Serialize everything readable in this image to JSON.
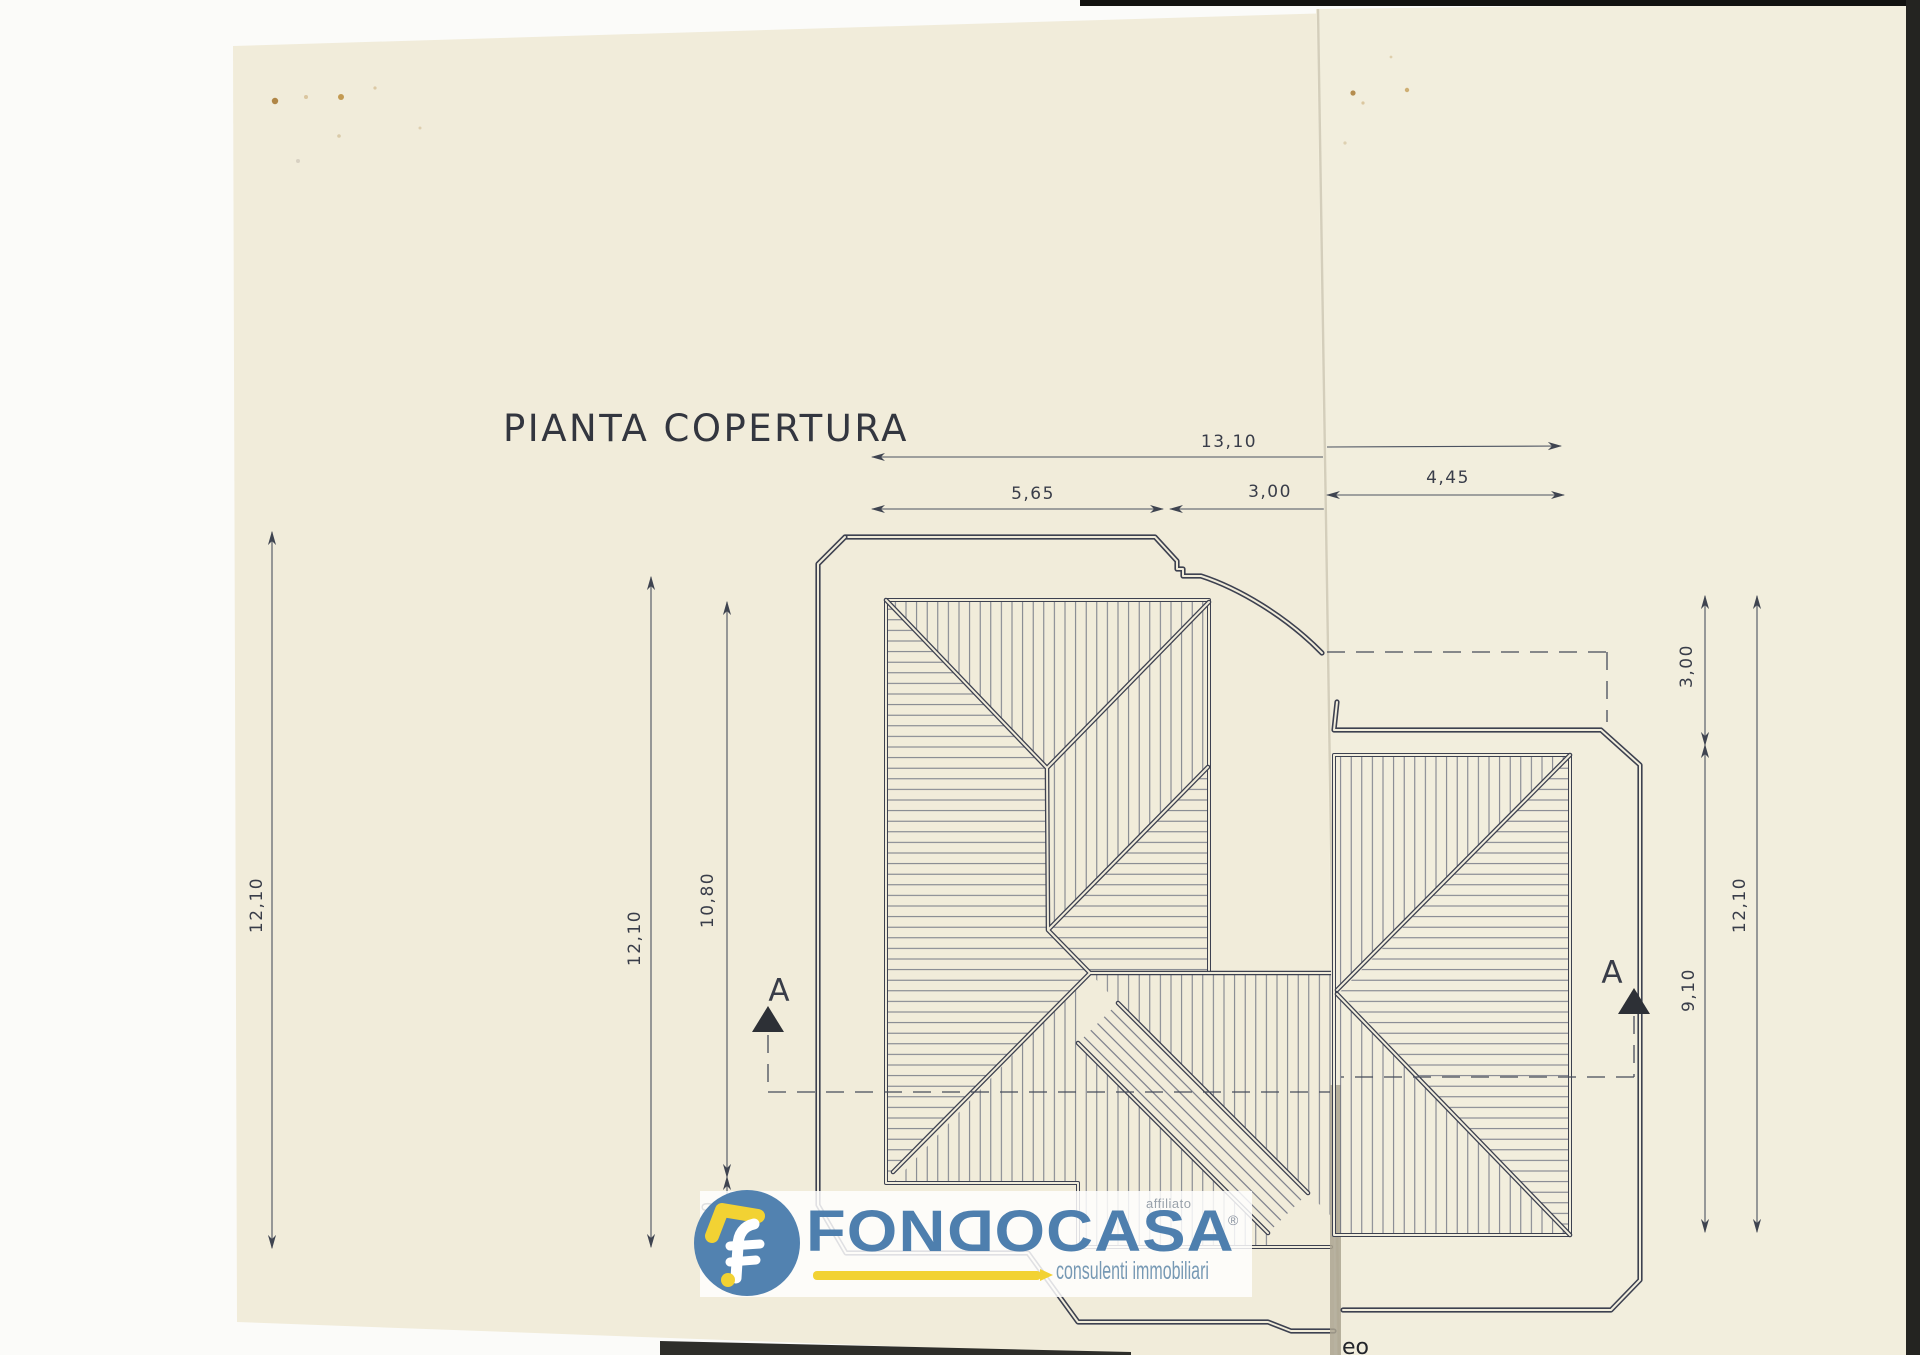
{
  "scan": {
    "title": "PIANTA COPERTURA",
    "partial_text": "eo",
    "paper_color_main": "#f1ecda",
    "paper_color_right": "#f2eedd",
    "line_color": "#3d4150"
  },
  "dimensions": {
    "top": {
      "total": "13,10",
      "segments": [
        "5,65",
        "3,00",
        "4,45"
      ]
    },
    "left": {
      "outer": "12,10",
      "inner": "12,10",
      "mid": "10,80",
      "eave": ",30"
    },
    "right": {
      "upper": "3,00",
      "lower": "9,10",
      "total": "12,10"
    },
    "section": {
      "left_label": "A",
      "right_label": "A"
    }
  },
  "logo": {
    "brand_pre": "FON",
    "brand_flipped": "D",
    "brand_post": "OCASA",
    "registered": "®",
    "affiliate": "affiliato",
    "tagline": "consulenti immobiliari",
    "blue": "#4e7fae",
    "yellow": "#f2d233"
  }
}
